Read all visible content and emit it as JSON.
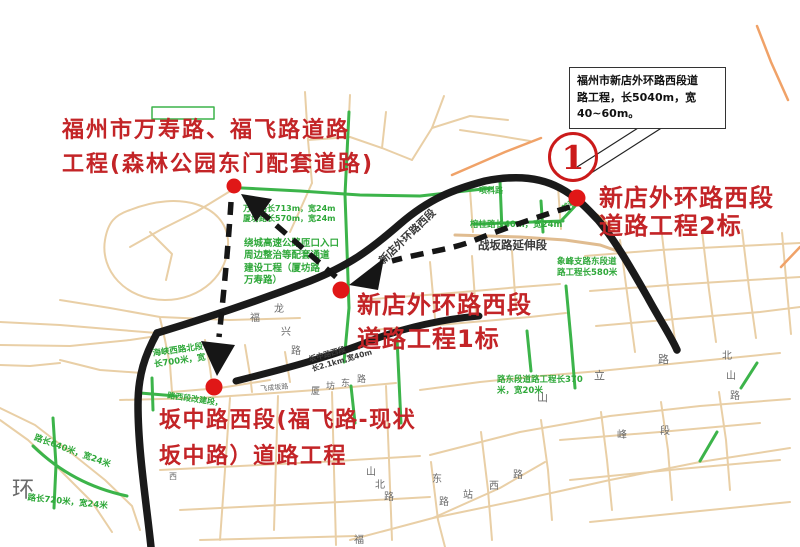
{
  "meta": {
    "title": "福州新店外环路片区道路工程示意图",
    "width": 800,
    "height": 547
  },
  "colors": {
    "annotation_red": "#c32427",
    "marker_red": "#e01717",
    "badge_red": "#cb1a1a",
    "planned_road_green": "#3cb44a",
    "green_note_text": "#2fa83a",
    "major_road_black": "#1a1a1a",
    "minor_road_tan": "#e9cfa6",
    "highway_orange": "#f0a268"
  },
  "infobox": {
    "lines": [
      "福州市新店外环路西段道",
      "路工程，长5040m，宽",
      "40~60m。"
    ]
  },
  "badge": {
    "number": "1"
  },
  "projects": [
    {
      "id": "wanshou",
      "lines": [
        "福州市万寿路、福飞路道路",
        "工程(森林公园东门配套道路)"
      ]
    },
    {
      "id": "seg1",
      "lines": [
        "新店外环路西段",
        "道路工程1标"
      ]
    },
    {
      "id": "seg2",
      "lines": [
        "新店外环路西段",
        "道路工程2标"
      ]
    },
    {
      "id": "banzhong",
      "lines": [
        "坂中路西段(福飞路-现状",
        "坂中路）道路工程"
      ]
    }
  ],
  "map_labels": [
    {
      "t": "新店外环路西段",
      "x": 377,
      "y": 258,
      "s": 10.5,
      "c": "dark",
      "r": -44
    },
    {
      "t": "战坂路延伸段",
      "x": 478,
      "y": 238,
      "s": 11.5,
      "c": "dark",
      "r": 0
    },
    {
      "t": "坂中路西段\n长2.1km,宽40m",
      "x": 308,
      "y": 355,
      "s": 7.5,
      "c": "dark",
      "r": -16
    },
    {
      "t": "万寿路长713m，宽24m\n厦坊路长570m，宽24m",
      "x": 243,
      "y": 204,
      "s": 8,
      "c": "green",
      "r": 0
    },
    {
      "t": "绕城高速公路匝口入口\n周边整治等配套通道\n建设工程（厦坊路\n万寿路）",
      "x": 244,
      "y": 238,
      "s": 9.5,
      "c": "green",
      "r": 0
    },
    {
      "t": "项科路",
      "x": 479,
      "y": 186,
      "s": 8,
      "c": "green",
      "r": 0
    },
    {
      "t": "榕桂路长40m，宽24m",
      "x": 470,
      "y": 220,
      "s": 8.5,
      "c": "green",
      "r": 0
    },
    {
      "t": "首科路",
      "x": 560,
      "y": 206,
      "s": 8,
      "c": "green",
      "r": -35
    },
    {
      "t": "象峰支路东段道\n路工程长580米",
      "x": 557,
      "y": 257,
      "s": 8.5,
      "c": "green",
      "r": 0
    },
    {
      "t": "路东段道路工程长370\n米，宽20米",
      "x": 497,
      "y": 375,
      "s": 8.5,
      "c": "green",
      "r": 0
    },
    {
      "t": "海峡西路北段\n长700米，宽",
      "x": 152,
      "y": 349,
      "s": 8.5,
      "c": "green",
      "r": -8
    },
    {
      "t": "路长640米，宽24米",
      "x": 36,
      "y": 433,
      "s": 8.5,
      "c": "green",
      "r": 20
    },
    {
      "t": "路长720米，宽24米",
      "x": 28,
      "y": 493,
      "s": 8.5,
      "c": "green",
      "r": 6
    },
    {
      "t": "路西段改建段，",
      "x": 168,
      "y": 391,
      "s": 8,
      "c": "green",
      "r": 8
    },
    {
      "t": "福",
      "x": 250,
      "y": 312,
      "s": 10,
      "c": "gray",
      "r": 0
    },
    {
      "t": "龙",
      "x": 274,
      "y": 303,
      "s": 10,
      "c": "gray",
      "r": 0
    },
    {
      "t": "兴",
      "x": 281,
      "y": 326,
      "s": 10,
      "c": "gray",
      "r": 0
    },
    {
      "t": "路",
      "x": 291,
      "y": 345,
      "s": 10,
      "c": "gray",
      "r": 0
    },
    {
      "t": "厦",
      "x": 311,
      "y": 387,
      "s": 9,
      "c": "gray",
      "r": 0
    },
    {
      "t": "坊",
      "x": 326,
      "y": 382,
      "s": 9,
      "c": "gray",
      "r": 0
    },
    {
      "t": "东",
      "x": 341,
      "y": 379,
      "s": 9,
      "c": "gray",
      "r": 0
    },
    {
      "t": "路",
      "x": 357,
      "y": 375,
      "s": 9,
      "c": "gray",
      "r": 0
    },
    {
      "t": "飞成坂路",
      "x": 260,
      "y": 385,
      "s": 7,
      "c": "gray",
      "r": -5
    },
    {
      "t": "山",
      "x": 366,
      "y": 466,
      "s": 10,
      "c": "gray",
      "r": 0
    },
    {
      "t": "北",
      "x": 375,
      "y": 479,
      "s": 10,
      "c": "gray",
      "r": 0
    },
    {
      "t": "路",
      "x": 384,
      "y": 491,
      "s": 10,
      "c": "gray",
      "r": 0
    },
    {
      "t": "东",
      "x": 432,
      "y": 473,
      "s": 10,
      "c": "gray",
      "r": 0
    },
    {
      "t": "路",
      "x": 439,
      "y": 496,
      "s": 10,
      "c": "gray",
      "r": 0
    },
    {
      "t": "站",
      "x": 463,
      "y": 489,
      "s": 10,
      "c": "gray",
      "r": 0
    },
    {
      "t": "西",
      "x": 489,
      "y": 480,
      "s": 10,
      "c": "gray",
      "r": 0
    },
    {
      "t": "路",
      "x": 513,
      "y": 469,
      "s": 10,
      "c": "gray",
      "r": 0
    },
    {
      "t": "环",
      "x": 12,
      "y": 477,
      "s": 22,
      "c": "gray",
      "r": 0
    },
    {
      "t": "山",
      "x": 537,
      "y": 391,
      "s": 11,
      "c": "gray",
      "r": 0
    },
    {
      "t": "立",
      "x": 594,
      "y": 369,
      "s": 11,
      "c": "gray",
      "r": 0
    },
    {
      "t": "路",
      "x": 658,
      "y": 353,
      "s": 11,
      "c": "gray",
      "r": 0
    },
    {
      "t": "峰",
      "x": 617,
      "y": 429,
      "s": 10,
      "c": "gray",
      "r": 0
    },
    {
      "t": "段",
      "x": 660,
      "y": 425,
      "s": 10,
      "c": "gray",
      "r": 0
    },
    {
      "t": "北",
      "x": 722,
      "y": 350,
      "s": 10,
      "c": "gray",
      "r": 0
    },
    {
      "t": "山",
      "x": 726,
      "y": 370,
      "s": 10,
      "c": "gray",
      "r": 0
    },
    {
      "t": "路",
      "x": 730,
      "y": 390,
      "s": 10,
      "c": "gray",
      "r": 0
    },
    {
      "t": "西",
      "x": 169,
      "y": 472,
      "s": 8,
      "c": "gray",
      "r": 0
    },
    {
      "t": "福",
      "x": 354,
      "y": 534,
      "s": 10,
      "c": "gray",
      "r": 0
    }
  ]
}
